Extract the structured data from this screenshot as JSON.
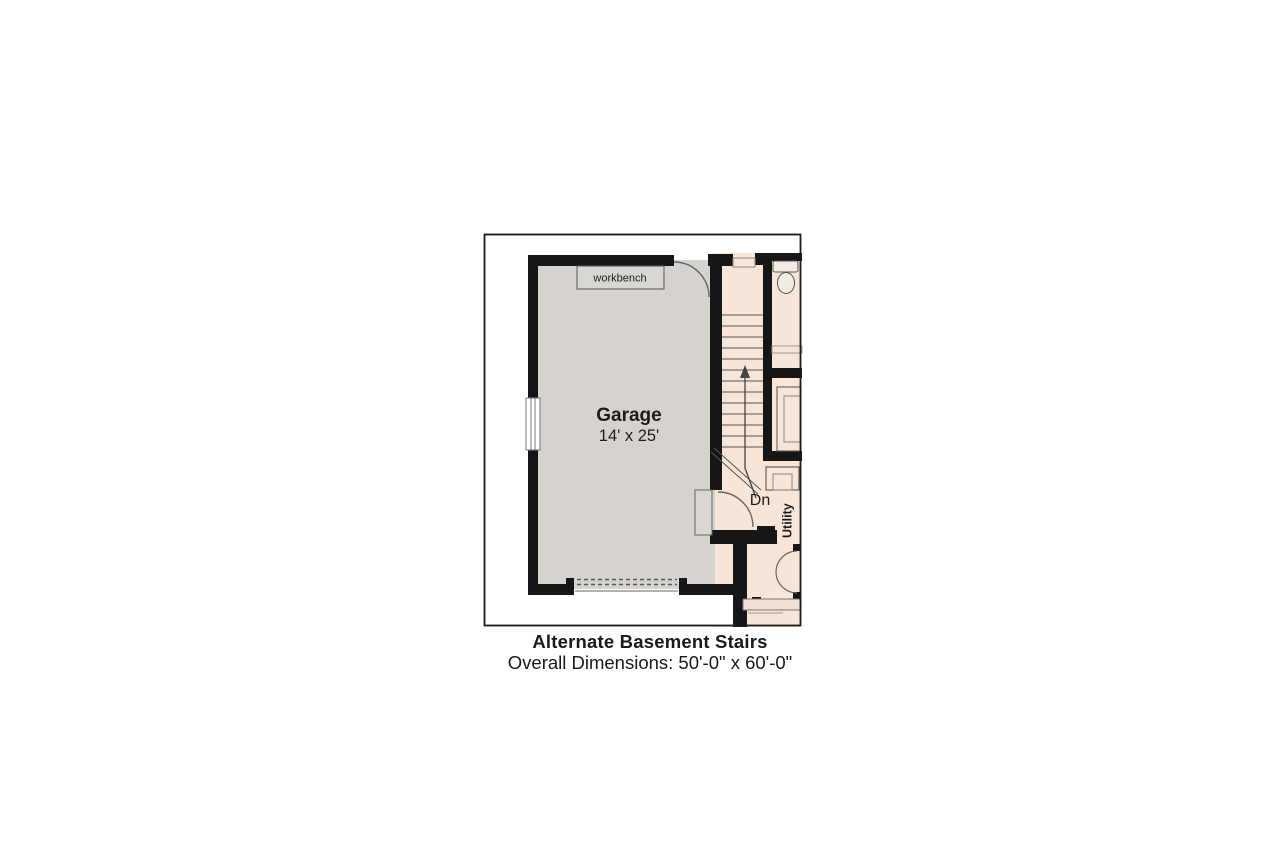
{
  "plan": {
    "rooms": {
      "garage": {
        "name": "Garage",
        "dimensions": "14' x 25'"
      },
      "utility": {
        "name": "Utility"
      }
    },
    "labels": {
      "workbench": "workbench",
      "stairs_direction": "Dn"
    },
    "caption": {
      "title": "Alternate Basement Stairs",
      "overall_dimensions": "Overall Dimensions: 50'-0\" x 60'-0\""
    },
    "colors": {
      "wall": "#161616",
      "garage_floor": "#d6d3cf",
      "interior_floor": "#f7e5d8",
      "fixture_fill": "#f2ece2",
      "thin_line": "#555555",
      "background": "#ffffff"
    }
  }
}
